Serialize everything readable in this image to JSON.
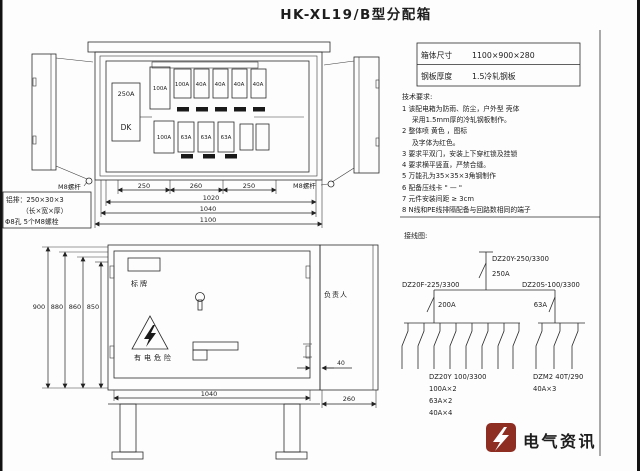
{
  "title": "HK-XL19/B型分配箱",
  "spec_table": {
    "rows": [
      {
        "label": "箱体尺寸",
        "value": "1100×900×280"
      },
      {
        "label": "钢板厚度",
        "value": "1.5冷轧钢板"
      }
    ]
  },
  "tech_notes": {
    "heading": "技术要求:",
    "lines": [
      "1 该配电箱为防雨、防尘，户外型 壳体",
      "采用1.5mm厚的冷轧钢板制作。",
      "2 整体喷  黄色 ，图标",
      "及字体为红色。",
      "3 要求平双门，安装上下穿杠锁及挂锁",
      "4 要求横平竖直，严禁合缝。",
      "5 万能孔为35×35×3角钢制作",
      "6 配备压线卡 \" — \"",
      "7 元件安装间距  ≥ 3cm",
      "8 N线和PE线排隔配备与回路数相同的端子"
    ]
  },
  "wiring": {
    "heading": "接线图:",
    "incoming": {
      "model": "DZ20Y-250/3300",
      "rating": "250A"
    },
    "left_branch": {
      "model": "DZ20F-225/3300",
      "rating": "200A"
    },
    "right_branch": {
      "model": "DZ20S-100/3300",
      "rating": "63A"
    },
    "left_group": {
      "model": "DZ20Y 100/3300",
      "line1": "100A×2",
      "line2": "63A×2",
      "line3": "40A×4",
      "breaker_count": 8
    },
    "right_group": {
      "model": "DZM2 40T/290",
      "line1": "40A×3",
      "breaker_count": 3
    }
  },
  "upper_view": {
    "main_switch_rating": "250A",
    "main_switch_label": "DK",
    "top_row": [
      "100A",
      "100A",
      "40A",
      "40A",
      "40A",
      "40A"
    ],
    "bottom_row": [
      "100A",
      "63A",
      "63A",
      "63A"
    ],
    "hinge_label_left": "M8螺杆",
    "hinge_label_right": "M8螺杆",
    "note_box": {
      "line1": "铝排：250×30×3",
      "line2": "（长×宽×厚）",
      "line3": "Φ8孔 5个M8螺栓"
    },
    "dims": {
      "seg1": "250",
      "seg2": "260",
      "seg3": "250",
      "total1": "1020",
      "total2": "1040",
      "total3": "1100"
    }
  },
  "front_view": {
    "nameplate": "标牌",
    "responsible": "负责人",
    "warning": "有电危险",
    "dims": {
      "h1": "900",
      "h2": "880",
      "h3": "860",
      "h4": "850",
      "width": "1040",
      "gap": "40",
      "depth": "260"
    }
  },
  "watermark": {
    "text": "电气资讯",
    "icon_color": "#8e2d22"
  }
}
